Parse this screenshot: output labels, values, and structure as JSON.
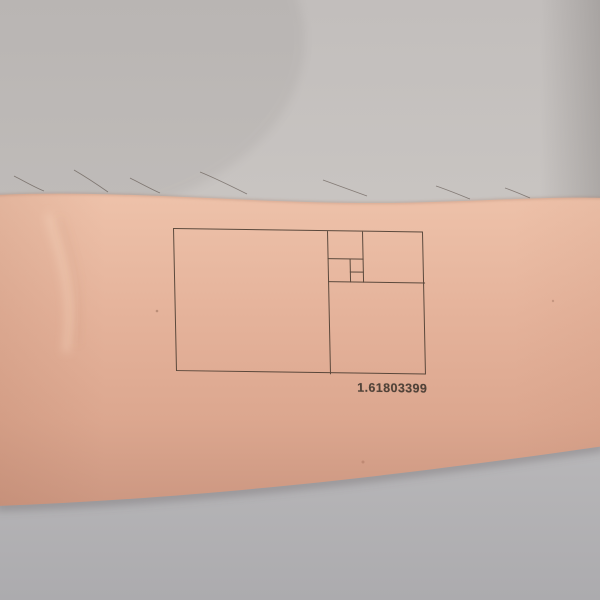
{
  "colors": {
    "backdrop_top": "#c9c5c2",
    "backdrop_bottom": "#b3b2b5",
    "skin_light": "#eec2aa",
    "skin_mid": "#e3b19a",
    "skin_shadow": "#cf9a84",
    "tattoo_line": "#483a2f",
    "tattoo_text": "#3d342c"
  },
  "tattoo": {
    "value_label": "1.61803399",
    "figure": {
      "x": 173,
      "y": 228,
      "width": 250,
      "height": 143,
      "rotation_deg": 0.8,
      "skew_deg": 2,
      "segments": [
        {
          "name": "main-vertical-divider",
          "x": 153,
          "y": 0,
          "w": 1.4,
          "h": 143
        },
        {
          "name": "strip-horizontal-divider",
          "x": 153,
          "y": 50,
          "w": 97,
          "h": 1.4
        },
        {
          "name": "strip-vertical-divider",
          "x": 188,
          "y": 0,
          "w": 1.4,
          "h": 51
        },
        {
          "name": "cluster-horizontal-divider",
          "x": 153,
          "y": 27,
          "w": 36.4,
          "h": 1.4
        },
        {
          "name": "cluster-vertical-divider",
          "x": 175,
          "y": 27,
          "w": 1.4,
          "h": 24.4
        },
        {
          "name": "tiny-horizontal-divider",
          "x": 175,
          "y": 40,
          "w": 14.4,
          "h": 1.4
        }
      ]
    }
  }
}
